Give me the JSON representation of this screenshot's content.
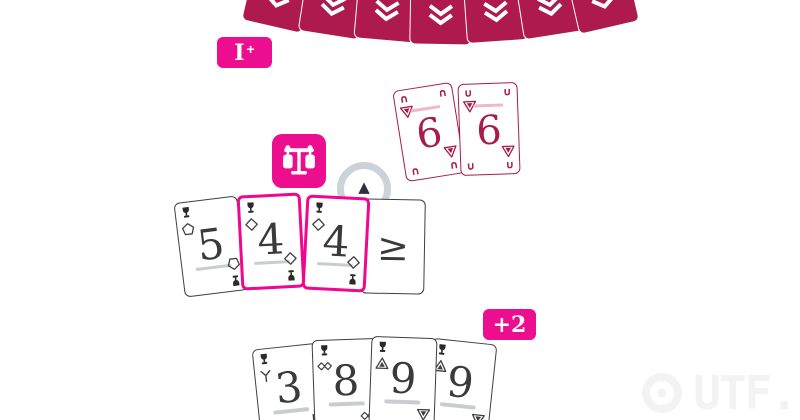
{
  "colors": {
    "card_back": "#AE1A4D",
    "accent_magenta": "#EC0E8E",
    "highlight_border": "#F0068F",
    "crimson_card": "#A81C4C",
    "card_border_gray": "#3F3F3F",
    "rank_ink": "#3A3A3A",
    "underline_gray": "#C9CDD1",
    "overline_pink": "#F2B5CB",
    "ring_gray": "#CBD2D8",
    "watermark_gray": "#F3F3F3"
  },
  "glyphs": {
    "horseshoe_down": "∩",
    "horseshoe_up": "∪",
    "direction_arrow": "▲"
  },
  "icons": {
    "corner_marker": "trophy",
    "balance_badge": "scale",
    "card_back_logo": "chevron-logo",
    "watermark_mark": "pixel-ring"
  },
  "badges": {
    "draw_label_main": "I",
    "draw_label_plus": "+",
    "penalty": "+2"
  },
  "opponent": {
    "card_count": 7
  },
  "cards": {
    "center_pile": [
      {
        "rank": "6",
        "suit": "triangle-down"
      },
      {
        "rank": "6",
        "suit": "triangle-down"
      }
    ],
    "middle_row": [
      {
        "rank": "5",
        "suit": "pentagon",
        "highlighted": false
      },
      {
        "rank": "4",
        "suit": "diamond",
        "highlighted": true
      },
      {
        "rank": "4",
        "suit": "diamond",
        "highlighted": true
      },
      {
        "rank": "≥",
        "suit": "",
        "highlighted": false
      }
    ],
    "player_hand": [
      {
        "rank": "3",
        "suit": "fork"
      },
      {
        "rank": "8",
        "suit": "double-diamond"
      },
      {
        "rank": "9",
        "suit": "triangle"
      },
      {
        "rank": "9",
        "suit": "triangle"
      }
    ]
  },
  "watermark": {
    "text": "UTF."
  }
}
